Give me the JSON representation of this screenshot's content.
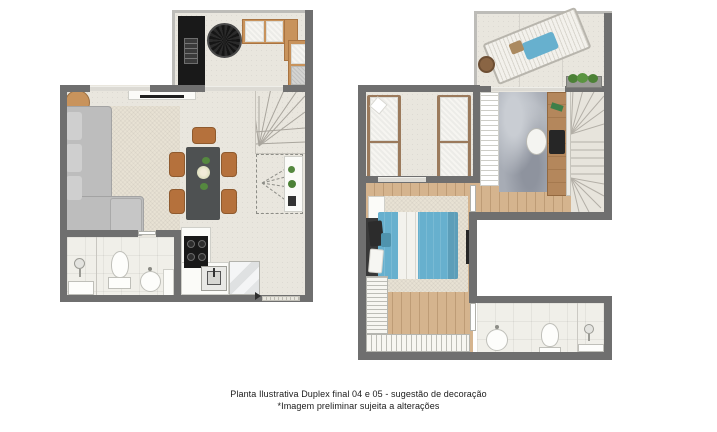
{
  "caption": {
    "line1": "Planta Ilustrativa Duplex final 04 e 05 - sugestão de decoração",
    "line2": "*Imagem preliminar sujeita a alterações"
  },
  "colors": {
    "wall": "#6f6f6f",
    "floor-tile": "#e9e6de",
    "floor-wood": "#d5b48e",
    "floor-bath": "#f0efe9",
    "rug-cream": "#e8e2d4",
    "rug-office": "#a7acb5",
    "sofa": "#bdbdbd",
    "wood": "#b5713c",
    "wood-light": "#c8935c",
    "table-dark": "#4e5152",
    "panel-black": "#191919",
    "accent-blue": "#67b0ce",
    "plant-green": "#55883f",
    "text": "#1a1a1a"
  }
}
